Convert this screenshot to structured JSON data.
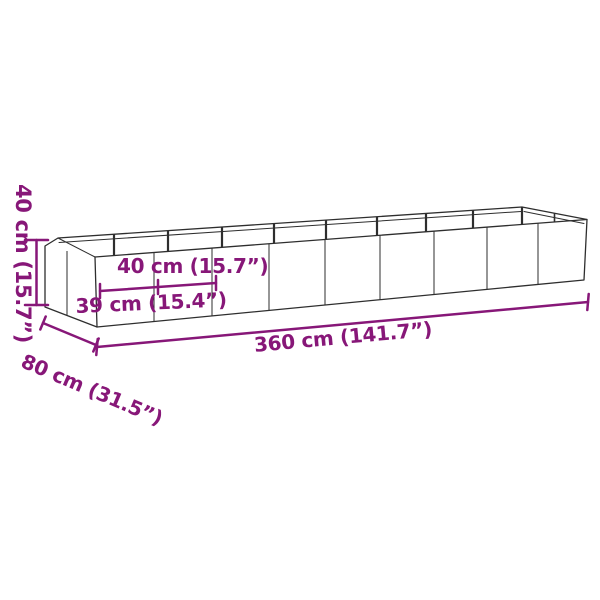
{
  "figure": {
    "kind": "product-dimension-diagram",
    "subject": "rectangular-garden-planter-wireframe",
    "background_color": "#ffffff",
    "outline_color": "#2e2e2e",
    "accent_color": "#871778"
  },
  "dimensions": {
    "height_label": "40 cm (15.7”)",
    "panel_width_label": "40 cm (15.7”)",
    "segment_label": "39 cm (15.4”)",
    "depth_label": "80 cm (31.5”)",
    "length_label": "360 cm (141.7”)"
  }
}
